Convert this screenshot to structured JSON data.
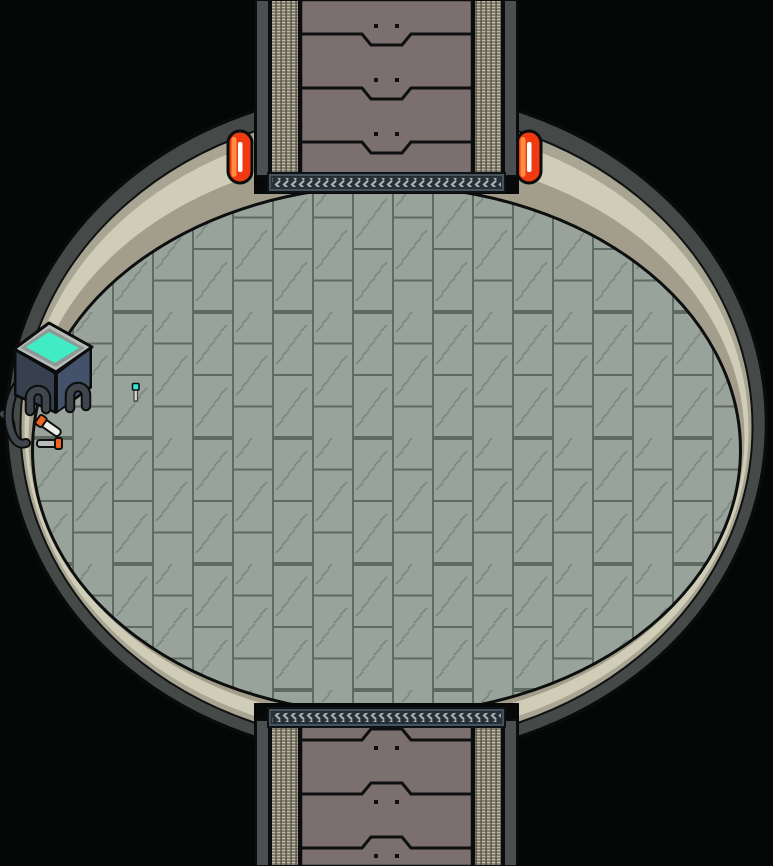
{
  "meta": {
    "scene_label": "top-down sci-fi elliptical chamber with north and south corridors",
    "width_px": 773,
    "height_px": 866
  },
  "palette": {
    "background": "#050606",
    "outline": "#0b0d0d",
    "wall_ring": "#454a48",
    "band_olive_outer": "#a9a593",
    "band_cream": "#cfcdb7",
    "band_olive_inner": "#a29e8b",
    "floor_base": "#98a39b",
    "floor_grout": "#5f6a62",
    "floor_hatch": "#7b887f",
    "corridor_panel": "#7c6f70",
    "corridor_mesh": "#c3bca1",
    "corridor_mesh_line": "#54524a",
    "corridor_wall": "#4a4f52",
    "threshold_frame": "#46525c",
    "threshold_inner": "#262f35",
    "threshold_chevron": "#a7adb0",
    "lamp_body": "#f13a10",
    "lamp_glow": "#ff8d42",
    "lamp_slit": "#ffffff",
    "console_top_frame": "#b9bebb",
    "console_top_inner": "#8e9894",
    "console_screen": "#41ebc3",
    "console_left": "#36404f",
    "console_right": "#43526a",
    "hose": "#3f464c",
    "vial_body_light": "#ecede9",
    "vial_body_gray": "#b9bdb9",
    "vial_cap": "#f0641e",
    "probe_head": "#3be3d4",
    "probe_stem": "#d9dad6"
  },
  "scene": {
    "room": {
      "label": "elliptical chamber",
      "floor_style": "vertical plank tiles with hatch marks"
    },
    "corridors": [
      {
        "id": "north",
        "position": "top",
        "panel_sections": 3,
        "threshold": "chevron tread strip"
      },
      {
        "id": "south",
        "position": "bottom",
        "panel_sections": 3,
        "threshold": "chevron tread strip"
      }
    ],
    "lamps": [
      {
        "id": "wall-lamp-left",
        "x": 240,
        "y": 157,
        "state": "lit"
      },
      {
        "id": "wall-lamp-right",
        "x": 529,
        "y": 157,
        "state": "lit"
      }
    ],
    "objects": [
      {
        "id": "console-table",
        "x": 54,
        "y": 368,
        "desc": "dark isometric console with glowing teal screen and ribbed hose legs"
      },
      {
        "id": "wall-cable",
        "x": 14,
        "y": 415,
        "desc": "ribbed hose running from console to left wall"
      },
      {
        "id": "vial-diagonal",
        "x": 50,
        "y": 424,
        "desc": "white vial with orange cap, tilted"
      },
      {
        "id": "vial-horizontal",
        "x": 50,
        "y": 443,
        "desc": "gray vial with orange cap, lying flat"
      },
      {
        "id": "probe-pin",
        "x": 136,
        "y": 390,
        "desc": "small upright probe with teal head"
      }
    ]
  }
}
